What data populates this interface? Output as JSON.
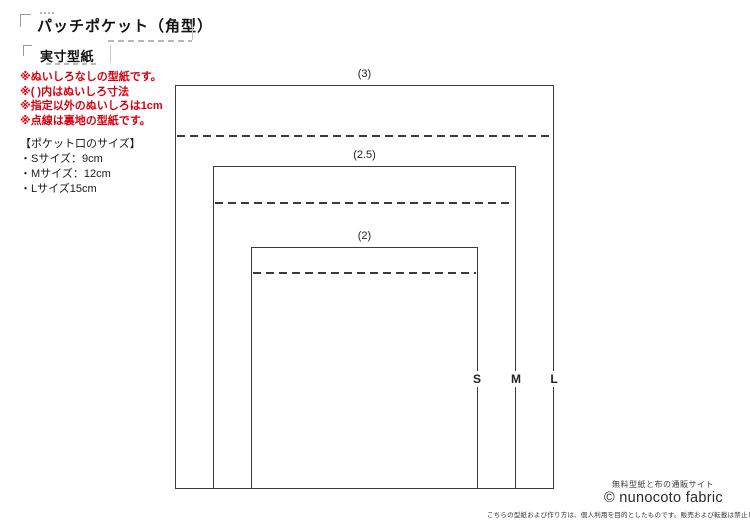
{
  "document": {
    "title": "パッチポケット（角型）",
    "subtitle": "実寸型紙"
  },
  "notes_red": {
    "color": "#dc0010",
    "lines": [
      "※ぬいしろなしの型紙です。",
      "※( )内はぬいしろ寸法",
      "※指定以外のぬいしろは1cm",
      "※点線は裏地の型紙です。"
    ]
  },
  "size_list": {
    "heading": "【ポケット口のサイズ】",
    "items": [
      "・Sサイズ：9cm",
      "・Mサイズ：12cm",
      "・Lサイズ15cm"
    ]
  },
  "pattern": {
    "line_color": "#3b3b3b",
    "seam_allowance_labels": {
      "l": "(3)",
      "m": "(2.5)",
      "s": "(2)"
    },
    "size_markers": {
      "s": "S",
      "m": "M",
      "l": "L"
    }
  },
  "footer": {
    "tagline": "無料型紙と布の通販サイト",
    "brand": "© nunocoto fabric",
    "disclaimer": "こちらの型紙および作り方は、個人利用を目的としたものです。販売および転載は禁止します。"
  }
}
